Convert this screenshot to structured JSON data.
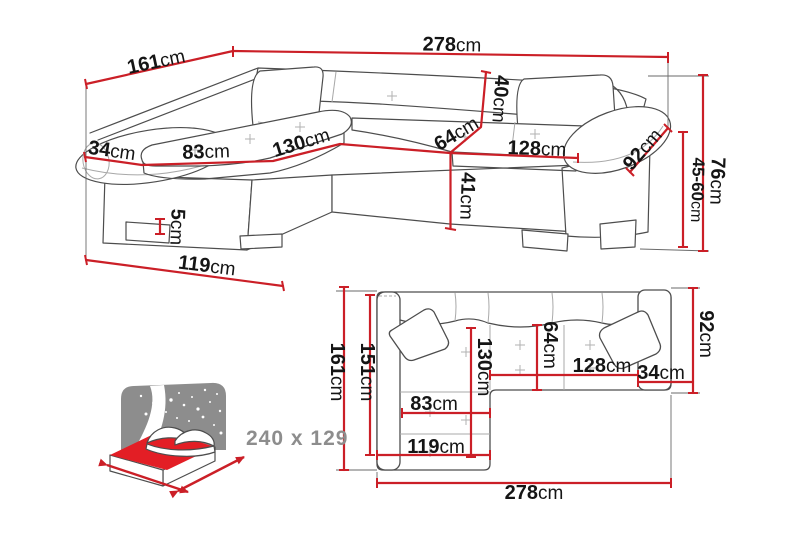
{
  "page": {
    "background": "#ffffff",
    "description": "corner sofa-bed dimension diagram"
  },
  "colors": {
    "dimension_red": "#cb1f27",
    "mattress_red": "#e31e25",
    "icon_gray": "#8d8d8d",
    "outline_gray": "#4d4d4d",
    "label_black": "#151515",
    "sleeping_label_gray": "#8d8d8d"
  },
  "front_view": {
    "name": "corner-sofa-front-perspective",
    "dims": {
      "total_width": {
        "v": "278",
        "u": "cm"
      },
      "side_depth": {
        "v": "161",
        "u": "cm"
      },
      "armrest_width": {
        "v": "34",
        "u": "cm"
      },
      "chaise_seat_width": {
        "v": "83",
        "u": "cm"
      },
      "chaise_length": {
        "v": "130",
        "u": "cm"
      },
      "backrest_height": {
        "v": "40",
        "u": "cm"
      },
      "seat_depth": {
        "v": "64",
        "u": "cm"
      },
      "seat_width": {
        "v": "128",
        "u": "cm"
      },
      "armrest_length": {
        "v": "92",
        "u": "cm"
      },
      "seat_height": {
        "v": "41",
        "u": "cm"
      },
      "leg_height": {
        "v": "5",
        "u": "cm"
      },
      "chaise_front_width": {
        "v": "119",
        "u": "cm"
      },
      "total_height": {
        "v": "76",
        "u": "cm"
      },
      "armrest_height_range": {
        "v": "45-60",
        "u": "cm"
      }
    }
  },
  "top_view": {
    "name": "corner-sofa-top-plan",
    "dims": {
      "side_depth": {
        "v": "161",
        "u": "cm"
      },
      "inner_depth": {
        "v": "151",
        "u": "cm"
      },
      "chaise_length": {
        "v": "130",
        "u": "cm"
      },
      "seat_depth": {
        "v": "64",
        "u": "cm"
      },
      "armrest_length": {
        "v": "92",
        "u": "cm"
      },
      "seat_width": {
        "v": "128",
        "u": "cm"
      },
      "armrest_width": {
        "v": "34",
        "u": "cm"
      },
      "chaise_seat_width": {
        "v": "83",
        "u": "cm"
      },
      "chaise_front_width": {
        "v": "119",
        "u": "cm"
      },
      "total_width": {
        "v": "278",
        "u": "cm"
      }
    }
  },
  "sleeping_area": {
    "label": "240 x 129",
    "icon": "bed-sleeping-function-icon"
  }
}
